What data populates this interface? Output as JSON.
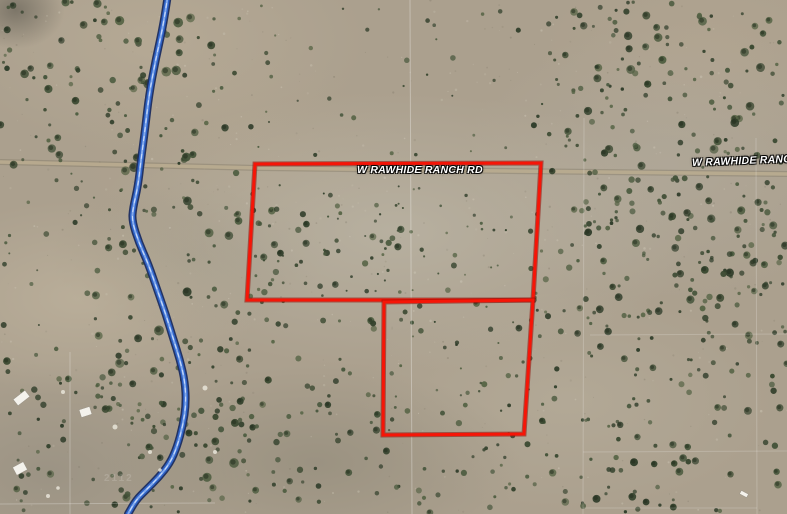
{
  "map": {
    "road_label_center": "W RAWHIDE RANCH RD",
    "road_label_right": "W RAWHIDE RANCH R",
    "watermark": "2112",
    "colors": {
      "parcel_stroke": "#f61507",
      "parcel_stroke_dark": "#8f0c05",
      "creek_outer": "#1b2c60",
      "creek_mid": "#2e62c6",
      "creek_inner": "#8fb4f0",
      "creek_highlight": "#dce9ff",
      "road_fill": "#bcae92",
      "road_edge": "#79705c",
      "grid_line": "#ffffff",
      "label_text": "#ffffff",
      "terrain_base": "#aba08e",
      "structure_fill": "#f4f2ec"
    },
    "parcels": {
      "upper": "255,164 541,163 533,300 247,300",
      "lower": "384,302 533,300 524,434 383,435"
    },
    "road": {
      "points": "0,162 260,168 420,170 600,172 787,174"
    },
    "creek_path": [
      [
        168,
        -6
      ],
      [
        164,
        22
      ],
      [
        156,
        58
      ],
      [
        149,
        95
      ],
      [
        145,
        130
      ],
      [
        141,
        160
      ],
      [
        138,
        186
      ],
      [
        133,
        208
      ],
      [
        132,
        221
      ],
      [
        139,
        243
      ],
      [
        148,
        263
      ],
      [
        158,
        292
      ],
      [
        166,
        315
      ],
      [
        173,
        338
      ],
      [
        180,
        360
      ],
      [
        185,
        382
      ],
      [
        186,
        404
      ],
      [
        183,
        425
      ],
      [
        177,
        447
      ],
      [
        170,
        463
      ],
      [
        159,
        477
      ],
      [
        146,
        490
      ],
      [
        136,
        500
      ],
      [
        128,
        514
      ]
    ],
    "grid_lines": [
      {
        "x1": 410,
        "y1": 0,
        "x2": 412,
        "y2": 514,
        "op": 0.3
      },
      {
        "x1": 584,
        "y1": 118,
        "x2": 583,
        "y2": 514,
        "op": 0.2
      },
      {
        "x1": 756,
        "y1": 138,
        "x2": 757,
        "y2": 514,
        "op": 0.2
      },
      {
        "x1": 70,
        "y1": 352,
        "x2": 70,
        "y2": 514,
        "op": 0.25
      },
      {
        "x1": 590,
        "y1": 335,
        "x2": 787,
        "y2": 334,
        "op": 0.18
      },
      {
        "x1": 583,
        "y1": 452,
        "x2": 787,
        "y2": 451,
        "op": 0.18
      },
      {
        "x1": 583,
        "y1": 508,
        "x2": 757,
        "y2": 508,
        "op": 0.18
      },
      {
        "x1": 0,
        "y1": 504,
        "x2": 215,
        "y2": 503,
        "op": 0.25
      }
    ],
    "terrain": {
      "seed": 1337,
      "shrub_colors": [
        "#2c3a27",
        "#37462e",
        "#425238",
        "#4d5c40",
        "#33412c",
        "#556344"
      ],
      "regions": [
        [
          545,
          0,
          242,
          168,
          130,
          1.5,
          4.5
        ],
        [
          100,
          0,
          125,
          170,
          60,
          1.5,
          5
        ],
        [
          0,
          0,
          100,
          170,
          40,
          1.5,
          4.5
        ],
        [
          225,
          5,
          320,
          150,
          40,
          1,
          3
        ],
        [
          585,
          168,
          202,
          170,
          150,
          1.5,
          4.2
        ],
        [
          533,
          165,
          55,
          190,
          22,
          1.5,
          3.5
        ],
        [
          95,
          170,
          160,
          330,
          110,
          1.5,
          5
        ],
        [
          0,
          170,
          95,
          185,
          22,
          1,
          3
        ],
        [
          250,
          185,
          165,
          112,
          75,
          1,
          3.8
        ],
        [
          415,
          185,
          120,
          112,
          22,
          1,
          3
        ],
        [
          180,
          295,
          205,
          110,
          40,
          1.5,
          4
        ],
        [
          385,
          300,
          148,
          135,
          45,
          1,
          3.5
        ],
        [
          555,
          338,
          232,
          50,
          30,
          1.5,
          3.5
        ],
        [
          0,
          360,
          160,
          154,
          50,
          1.5,
          4
        ],
        [
          160,
          400,
          225,
          114,
          55,
          1.5,
          4
        ],
        [
          385,
          435,
          175,
          79,
          28,
          1.5,
          3.5
        ],
        [
          540,
          388,
          247,
          126,
          70,
          1.5,
          4
        ]
      ],
      "light_speckles": 260,
      "dark_speckles": 220
    },
    "structures": [
      {
        "x": 14,
        "y": 394,
        "w": 15,
        "h": 8,
        "rot": -38
      },
      {
        "x": 80,
        "y": 408,
        "w": 11,
        "h": 8,
        "rot": -18
      },
      {
        "x": 14,
        "y": 464,
        "w": 12,
        "h": 9,
        "rot": -28
      },
      {
        "x": 740,
        "y": 492,
        "w": 8,
        "h": 4,
        "rot": 28
      }
    ],
    "debris_dots": [
      [
        63,
        392,
        2
      ],
      [
        115,
        427,
        2.5
      ],
      [
        150,
        452,
        2
      ],
      [
        205,
        388,
        2.5
      ],
      [
        48,
        496,
        2
      ],
      [
        58,
        488,
        1.8
      ],
      [
        160,
        470,
        1.8
      ],
      [
        215,
        452,
        2
      ]
    ]
  }
}
